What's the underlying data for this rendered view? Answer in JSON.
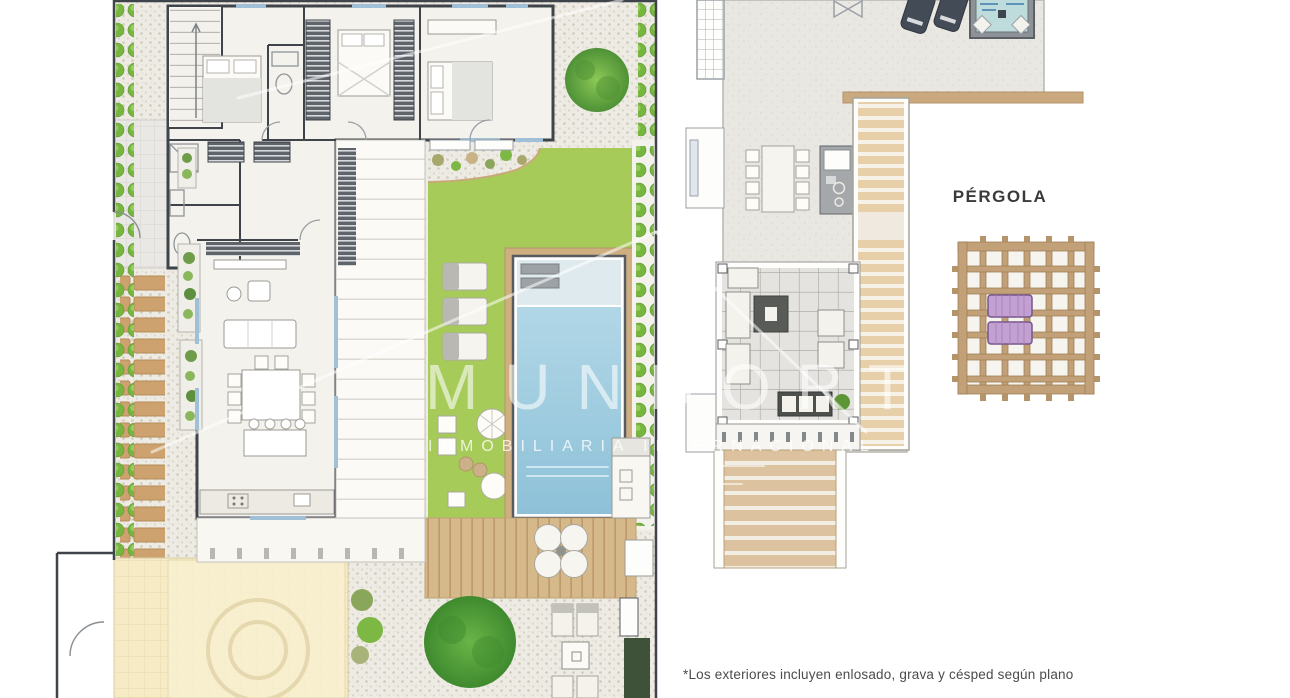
{
  "window": {
    "width": 1290,
    "height": 698,
    "background": "#ffffff"
  },
  "watermark": {
    "brand": "MUNDORT",
    "tagline": "INMOBILIARIA INTERNACIONAL"
  },
  "labels": {
    "pergola": "PÉRGOLA"
  },
  "footnote": {
    "text": "*Los exteriores incluyen enlosado, grava y césped según plano"
  },
  "colors": {
    "lawn": "#a6cb58",
    "gravel": "#edebe3",
    "deck_wood": "#d6b98b",
    "pool_water": "#a9d4e6",
    "pool_shelf": "#dfeaee",
    "terrace": "#e9e7e1",
    "wall": "#3f444b",
    "room": "#f4f2ec",
    "yellow_tiles": "#f6ebc5",
    "pergola_wood": "#c2a078",
    "purple_lounger": "#c2a0d2",
    "dark_hedge": "#3e5239",
    "bush_green": "#76b53e",
    "glazing": "#9fc0d6",
    "label_text": "#3a3a3a",
    "footnote_text": "#4b4b4b"
  }
}
